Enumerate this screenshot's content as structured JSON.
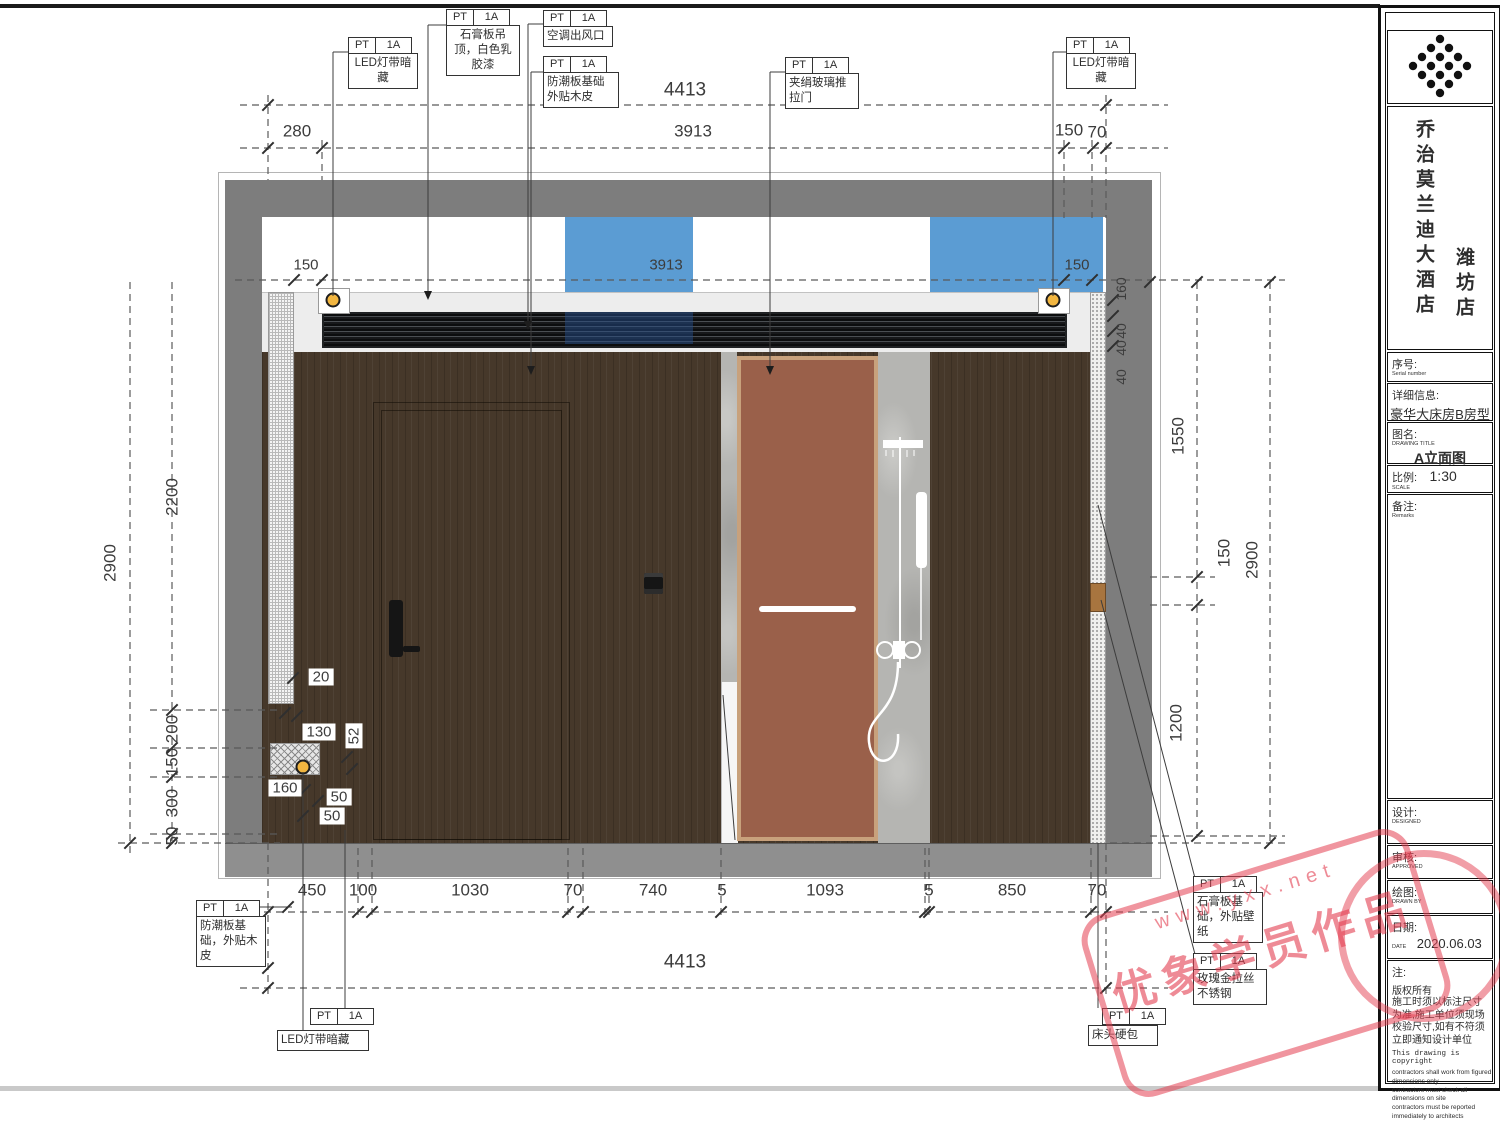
{
  "callouts": [
    {
      "tag": "PT",
      "code": "1A",
      "text": "LED灯带暗\n藏"
    },
    {
      "tag": "PT",
      "code": "1A",
      "text": "石膏板吊\n顶，白色乳\n胶漆"
    },
    {
      "tag": "PT",
      "code": "1A",
      "text": "空调出风口"
    },
    {
      "tag": "PT",
      "code": "1A",
      "text": "防潮板基础\n外贴木皮"
    },
    {
      "tag": "PT",
      "code": "1A",
      "text": "夹绢玻璃推\n拉门"
    },
    {
      "tag": "PT",
      "code": "1A",
      "text": "LED灯带暗\n藏"
    },
    {
      "tag": "PT",
      "code": "1A",
      "text": "防潮板基\n础，外贴木\n皮"
    },
    {
      "tag": "PT",
      "code": "1A",
      "text": "LED灯带暗藏"
    },
    {
      "tag": "PT",
      "code": "1A",
      "text": "石膏板基\n础，外贴壁\n纸"
    },
    {
      "tag": "PT",
      "code": "1A",
      "text": "玫瑰金拉丝\n不锈钢"
    },
    {
      "tag": "PT",
      "code": "1A",
      "text": "床头硬包"
    }
  ],
  "dimensions": {
    "top_total": "4413",
    "top_row": [
      "280",
      "3913",
      "150",
      "70"
    ],
    "ceiling_row": [
      "150",
      "3913",
      "150"
    ],
    "bottom_row": [
      "450",
      "100",
      "1030",
      "70",
      "740",
      "5",
      "1093",
      "5",
      "850",
      "70"
    ],
    "bottom_total": "4413",
    "left": [
      "2900",
      "2200",
      "200",
      "150",
      "300",
      "50"
    ],
    "right": [
      "160",
      "40",
      "40",
      "40",
      "1550",
      "150",
      "2900",
      "1200"
    ],
    "detail": [
      "20",
      "130",
      "52",
      "160",
      "50",
      "50"
    ]
  },
  "title_block": {
    "hotel_name": "乔治莫兰迪大酒店",
    "branch": "潍坊店",
    "serial_label": "序号:",
    "serial_sub": "Serial number",
    "info_label": "详细信息:",
    "info_value": "豪华大床房B房型",
    "drawing_label": "图名:",
    "drawing_sub": "DRAWING TITLE",
    "drawing_value": "A立面图",
    "scale_label": "比例:",
    "scale_sub": "SCALE",
    "scale_value": "1:30",
    "remarks_label": "备注:",
    "remarks_sub": "Remarks",
    "design_label": "设计:",
    "design_sub": "DESIGNED",
    "review_label": "审核:",
    "review_sub": "APPROVED",
    "draw_label": "绘图:",
    "draw_sub": "DRAWN BY",
    "date_label": "日期:",
    "date_sub": "DATE",
    "date_value": "2020.06.03",
    "note_label": "注:",
    "note_cn1": "版权所有",
    "note_cn2": "施工时须以标注尺寸为准,施工单位须现场校验尺寸,如有不符须立即通知设计单位",
    "note_en_title": "This drawing is copyright",
    "note_en_lines": "contractors shall work from figured\ndimensions only\ncontractors must check all\ndimensions on site\ncontractors must be reported\nimmediately  to architects"
  },
  "watermark": {
    "url": "www.yxx.net",
    "text": "优象学员作品"
  },
  "colors": {
    "wall_gray": "#7d7d7d",
    "panel_blue": "#5b9cd3",
    "wood": "#46382a",
    "door_brown": "#9a604a",
    "stamp_red": "#e33e50"
  }
}
